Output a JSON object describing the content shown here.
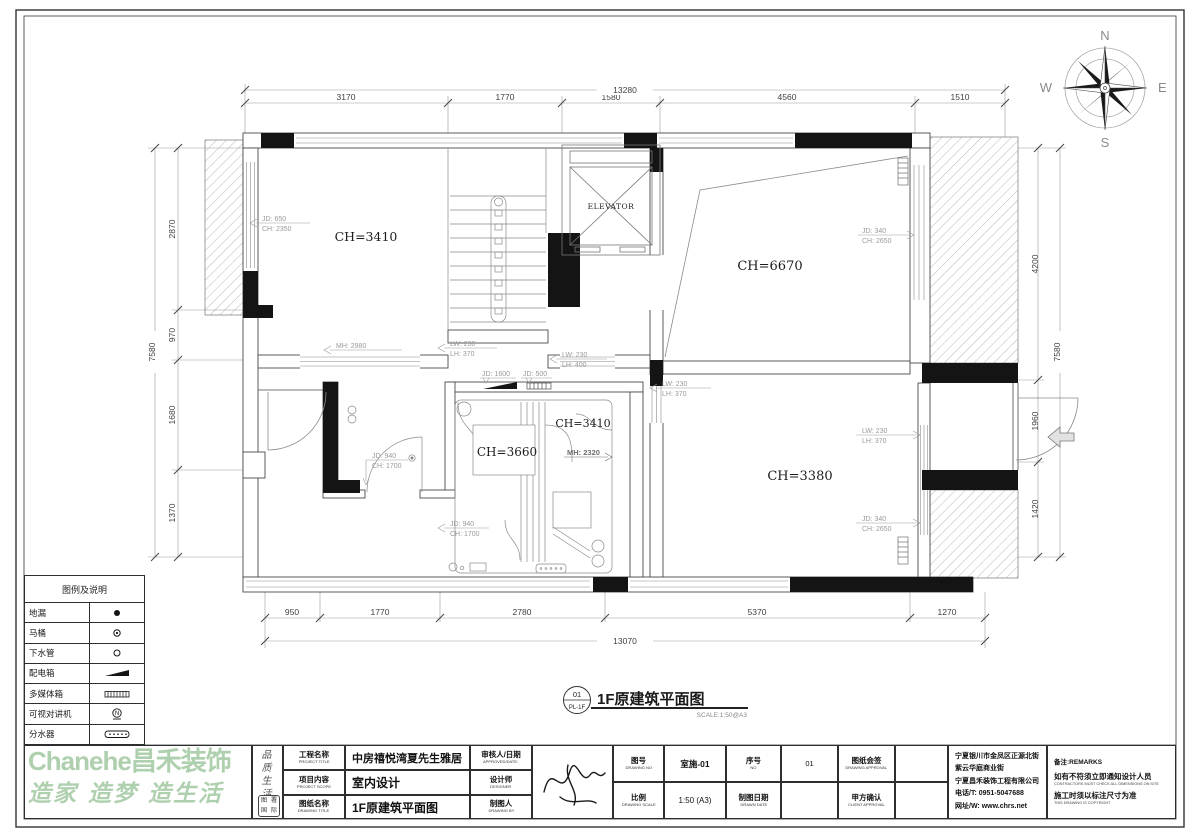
{
  "sheet": {
    "drawing_label": {
      "bubble_top": "01",
      "bubble_bottom": "PL-1F",
      "title": "1F原建筑平面图",
      "scale": "SCALE:1:50@A3"
    },
    "compass": {
      "north": "N",
      "south": "S",
      "east": "E",
      "west": "W"
    }
  },
  "plan": {
    "rooms": {
      "r1": "CH=3410",
      "r2": "CH=6670",
      "r3": "CH=3660",
      "r4": "CH=3410",
      "r5": "CH=3380",
      "elevator": "ELEVATOR"
    },
    "ann": {
      "a1a": "JD: 650",
      "a1b": "CH: 2350",
      "a2": "MH: 2980",
      "a3a": "LW: 230",
      "a3b": "LH: 370",
      "a4a": "LW: 230",
      "a4b": "LH: 400",
      "a5": "JD: 1600",
      "a6": "JD: 500",
      "a7a": "LW: 230",
      "a7b": "LH: 370",
      "a8a": "JD: 340",
      "a8b": "CH: 2650",
      "a9a": "LW: 230",
      "a9b": "LH: 370",
      "a10a": "JD: 340",
      "a10b": "CH: 2650",
      "a11a": "JD: 940",
      "a11b": "CH: 1700",
      "a12a": "JD: 940",
      "a12b": "CH: 1700",
      "a13": "MH: 2320"
    },
    "dims": {
      "top_total": "13280",
      "top1": "3170",
      "top2": "1770",
      "top3": "1580",
      "top4": "4560",
      "top5": "1510",
      "bottom_total": "13070",
      "b1": "950",
      "b2": "1770",
      "b3": "2780",
      "b4": "5370",
      "b5": "1270",
      "left_total": "7580",
      "l1": "2870",
      "l2": "970",
      "l3": "1680",
      "l4": "1370",
      "right_total": "7580",
      "r1": "4200",
      "r2": "1960",
      "r3": "1420"
    }
  },
  "legend": {
    "title": "图例及说明",
    "items": [
      {
        "name": "地漏",
        "symbol": "floor-drain"
      },
      {
        "name": "马桶",
        "symbol": "toilet"
      },
      {
        "name": "下水管",
        "symbol": "drain-pipe"
      },
      {
        "name": "配电箱",
        "symbol": "power-box"
      },
      {
        "name": "多媒体箱",
        "symbol": "media-box"
      },
      {
        "name": "可视对讲机",
        "symbol": "video-intercom"
      },
      {
        "name": "分水器",
        "symbol": "water-manifold"
      }
    ]
  },
  "titleblock": {
    "project_label_cn": "工程名称",
    "project_label_en": "PROJECT TITLE",
    "project_value": "中房禧悦湾夏先生雅居",
    "scope_label_cn": "项目内容",
    "scope_label_en": "PROJECT SCOPE",
    "scope_value": "室内设计",
    "dwgname_label_cn": "图纸名称",
    "dwgname_label_en": "DRAWING TITLE",
    "dwgname_value": "1F原建筑平面图",
    "approved_label_cn": "审核人/日期",
    "approved_label_en": "APPROVED/DATE:",
    "designer_label_cn": "设计师",
    "designer_label_en": "DESIGNER",
    "drawnby_label_cn": "制图人",
    "drawnby_label_en": "DRAWING BY",
    "dwgno_label_cn": "图号",
    "dwgno_label_en": "DRAWING NO",
    "dwgno_value": "室施-01",
    "no_label_cn": "序号",
    "no_label_en": "NO",
    "no_value": "01",
    "approval_label_cn": "图纸会签",
    "approval_label_en": "DRAWING APPROVAL",
    "scale_label_cn": "比例",
    "scale_label_en": "DRAWING SCALE",
    "scale_value": "1:50 (A3)",
    "date_label_cn": "制图日期",
    "date_label_en": "DRAWN DATE",
    "client_label_cn": "甲方确认",
    "client_label_en": "CLIENT APPROVAL",
    "company": {
      "line1": "宁夏银川市金凤区正源北街",
      "line2": "紫云华庭商业街",
      "line3": "宁夏昌禾装饰工程有限公司",
      "line4": "电话/T: 0951-5047688",
      "line5": "网址/W: www.chrs.net"
    },
    "remarks": {
      "label": "备注:REMARKS",
      "line1": "如有不符须立即通知设计人员",
      "line1_en": "CONTRACTORS MUST CHECK ALL DIMENSIONS ON SITE",
      "line2": "施工时须以标注尺寸为准",
      "line2_en": "THIS DRAWING IS COPYRIGHT"
    }
  },
  "watermark": {
    "brand": "Chanehe昌禾装饰",
    "slogan": "造家 造梦 造生活",
    "vertical_slogan": "品质生活",
    "seal1": "图",
    "seal2": "署",
    "seal3": "国",
    "seal4": "际"
  },
  "colors": {
    "watermark_green": "#aed0ae",
    "line_dark": "#444444",
    "annotation_gray": "#9a9a9a",
    "black_fill": "#141414"
  }
}
